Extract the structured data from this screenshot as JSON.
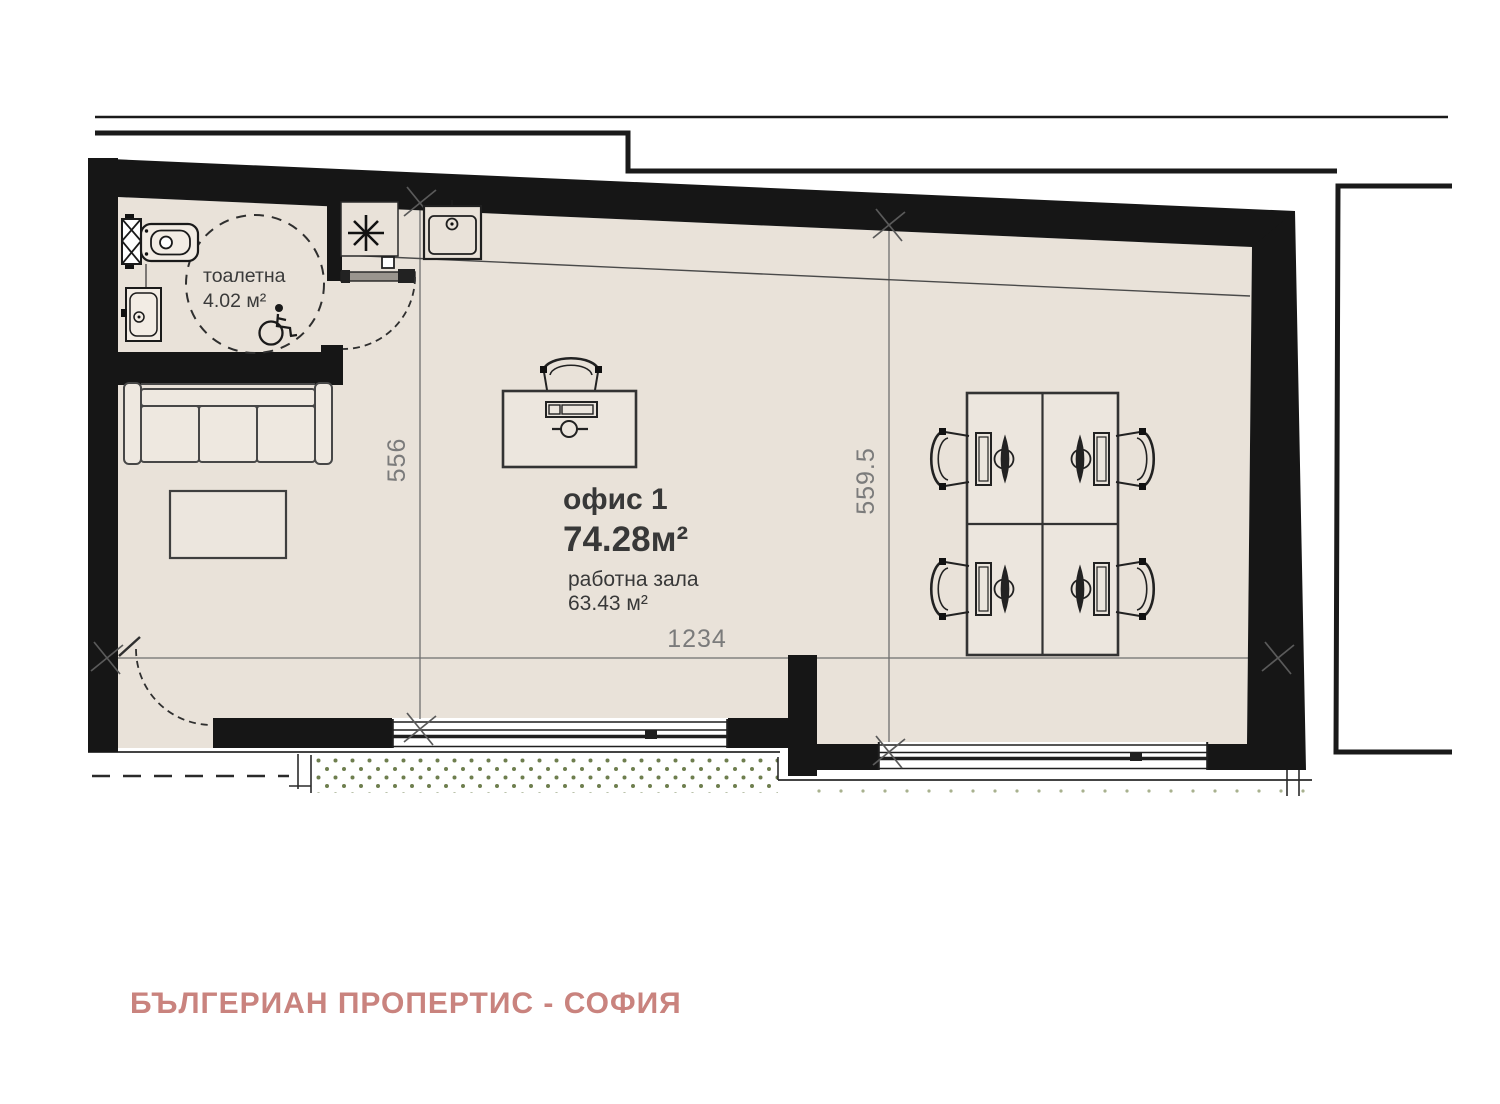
{
  "toilet": {
    "name": "тоалетна",
    "area": "4.02 м²"
  },
  "office": {
    "name": "офис 1",
    "area": "74.28м²",
    "zone_name": "работна зала",
    "zone_area": "63.43 м²"
  },
  "dimensions": {
    "horizontal": "1234",
    "left_vertical": "556",
    "right_vertical": "559.5"
  },
  "branding": {
    "agency": "БЪЛГЕРИАН ПРОПЕРТИС - СОФИЯ"
  },
  "icons": {
    "boiler_symbol": "asterisk-star",
    "accessibility": "wheelchair",
    "fixtures": [
      "radiator",
      "wc-toilet",
      "washbasin",
      "kitchen-sink"
    ]
  },
  "colors": {
    "wall": "#161616",
    "floor": "#e9e2d9",
    "furniture_fill": "#ece6de",
    "drawing_line": "#3d3d3d",
    "grid_line": "#6f6f6f",
    "dimension_text": "#7b7b7b",
    "label_text": "#383838",
    "terrace_dot": "#6e7e4e",
    "brand_accent": "#c9837e"
  }
}
